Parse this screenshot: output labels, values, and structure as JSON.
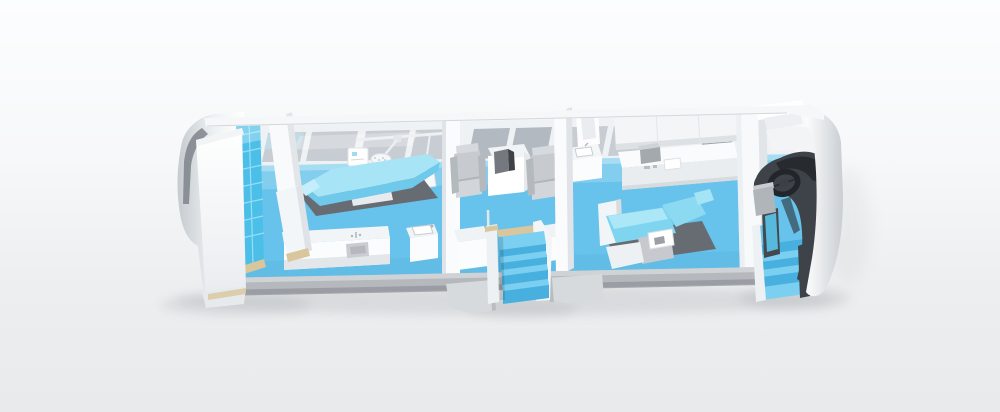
{
  "meta": {
    "description": "3D cutaway illustration of a mobile medical clinic vehicle interior",
    "view": "elevated oblique cutaway, near wall removed"
  },
  "palette": {
    "background_top": "#fcfdfe",
    "background_bottom": "#e8eaec",
    "wall_white": "#f5f7f9",
    "wall_shade": "#e0e4e8",
    "chassis_gray": "#b5b9be",
    "floor_blue": "#68c3ec",
    "window_sill_blue": "#a6ddf3",
    "window_glass": "#c8cdd3",
    "window_glass_dark": "#b3b9c0",
    "glass_panel_blue": "#4cbfe9",
    "steps_top": "#7bcff0",
    "steps_face": "#47b0df",
    "seat_gray": "#c7cbd0",
    "mat_dark": "#676c72",
    "chair_cyan": "#6fc9eb",
    "chair_cyan_light": "#a7e5f6",
    "counter_front": "#e9edf0",
    "dashboard_dark": "#3e434a",
    "screen_blue": "#57badd",
    "wood_trim": "#d9c69c",
    "shadow_gray": "#8d9297"
  },
  "scene": {
    "vehicle": "mobile-clinic-trailer-cutaway",
    "rooms": [
      {
        "name": "rear-storage",
        "objects": [
          "storage-cabinet",
          "glass-panel-wall",
          "partition-panels"
        ]
      },
      {
        "name": "operating-room",
        "objects": [
          "operating-table",
          "floor-mat",
          "overhead-surgical-light",
          "equipment-cart",
          "arm-mounted-panel",
          "supply-counter",
          "sink-cabinet"
        ]
      },
      {
        "name": "entry-vestibule",
        "objects": [
          "passenger-seat-left",
          "passenger-seat-right",
          "side-table",
          "table-console",
          "storage-block-left",
          "storage-block-right",
          "glass-divider",
          "entry-steps"
        ]
      },
      {
        "name": "treatment-room",
        "objects": [
          "dental-chair",
          "floor-mat",
          "corner-sink",
          "corner-frame",
          "wall-counter",
          "counter-equipment",
          "overhead-cabinet"
        ]
      },
      {
        "name": "driver-cab",
        "objects": [
          "dashboard",
          "steering-wheel",
          "driver-console",
          "cab-monitor",
          "cab-steps"
        ]
      }
    ],
    "exterior": [
      "roof-rail",
      "window-band",
      "rear-shell",
      "chassis-skirt",
      "entry-skirt",
      "cab-body-wrap",
      "ground-shadow"
    ]
  }
}
